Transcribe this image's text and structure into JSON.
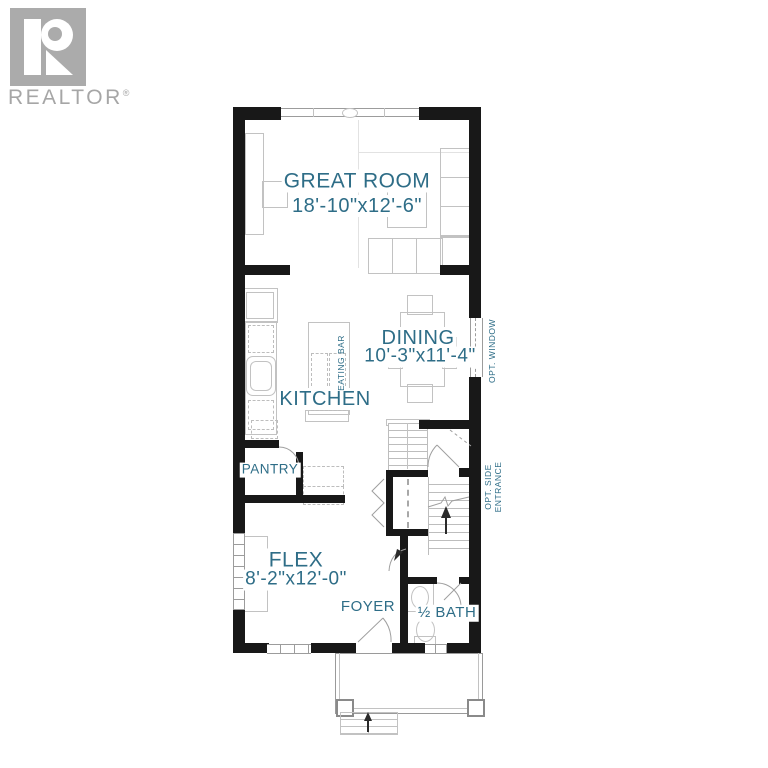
{
  "branding": {
    "logo_letter": "R",
    "wordmark": "REALTOR",
    "reg": "®"
  },
  "rooms": {
    "great_room": {
      "name": "GREAT ROOM",
      "dims": "18'-10\"x12'-6\""
    },
    "dining": {
      "name": "DINING",
      "dims": "10'-3\"x11'-4\""
    },
    "kitchen": {
      "name": "KITCHEN"
    },
    "pantry": {
      "name": "PANTRY"
    },
    "flex": {
      "name": "FLEX",
      "dims": "8'-2\"x12'-0\""
    },
    "foyer": {
      "name": "FOYER"
    },
    "half_bath": {
      "name": "½ BATH"
    }
  },
  "annotations": {
    "eating_bar": "EATING BAR",
    "opt_window": "OPT. WINDOW",
    "opt_side_entrance_line1": "OPT. SIDE",
    "opt_side_entrance_line2": "ENTRANCE"
  },
  "colors": {
    "label_teal": "#2e6d87",
    "wall_black": "#181818",
    "fixture_gray": "#c2c2c2",
    "logo_gray": "#ababab"
  }
}
